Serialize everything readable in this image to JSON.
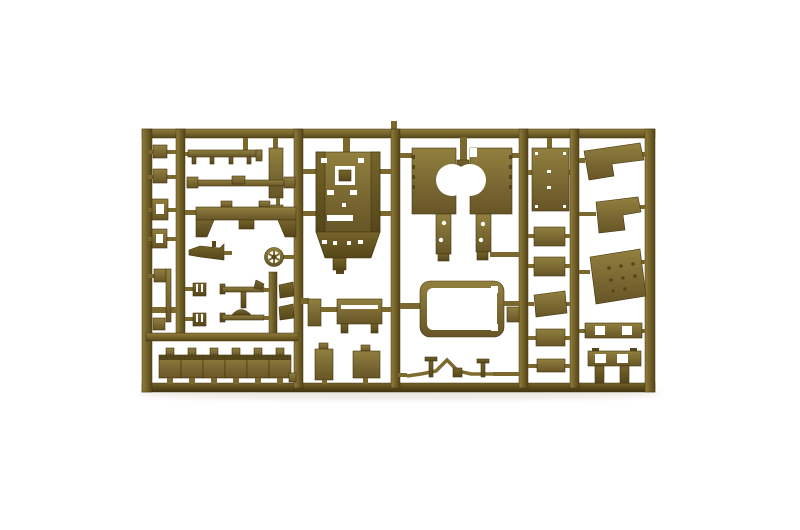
{
  "scene": {
    "description": "Product photo of an olive-drab plastic model kit sprue (injection-moulded parts tree) on a plain white background",
    "object": "model-kit-sprue",
    "orientation": "horizontal rectangular frame with five internal vertical runners"
  },
  "colors": {
    "background": "#ffffff",
    "plastic_light": "#8f7d3e",
    "plastic_mid": "#76642a",
    "plastic_dark": "#55461a",
    "bottom_dark": "#403310",
    "part_light": "#91803f",
    "part_mid": "#7d6b31",
    "part_shadow": "#675527",
    "runner_mid": "#7a682e",
    "outline": "#42350f",
    "hole": "#ffffff",
    "photo_shadow": "#c9c3b4"
  },
  "parts_inventory": [
    "small-brackets-column",
    "toothed-rail",
    "long-rail",
    "u-bracket",
    "gun-barrel",
    "steering-wheel",
    "vent-caps",
    "gear-levers",
    "hull-shell",
    "bench-seat",
    "storage-boxes-row",
    "mudguard-plates",
    "window-frame",
    "tow-bar",
    "hatch-panels-column",
    "fender-plates",
    "trapezoid-plate",
    "slotted-rail",
    "rear-bench"
  ]
}
